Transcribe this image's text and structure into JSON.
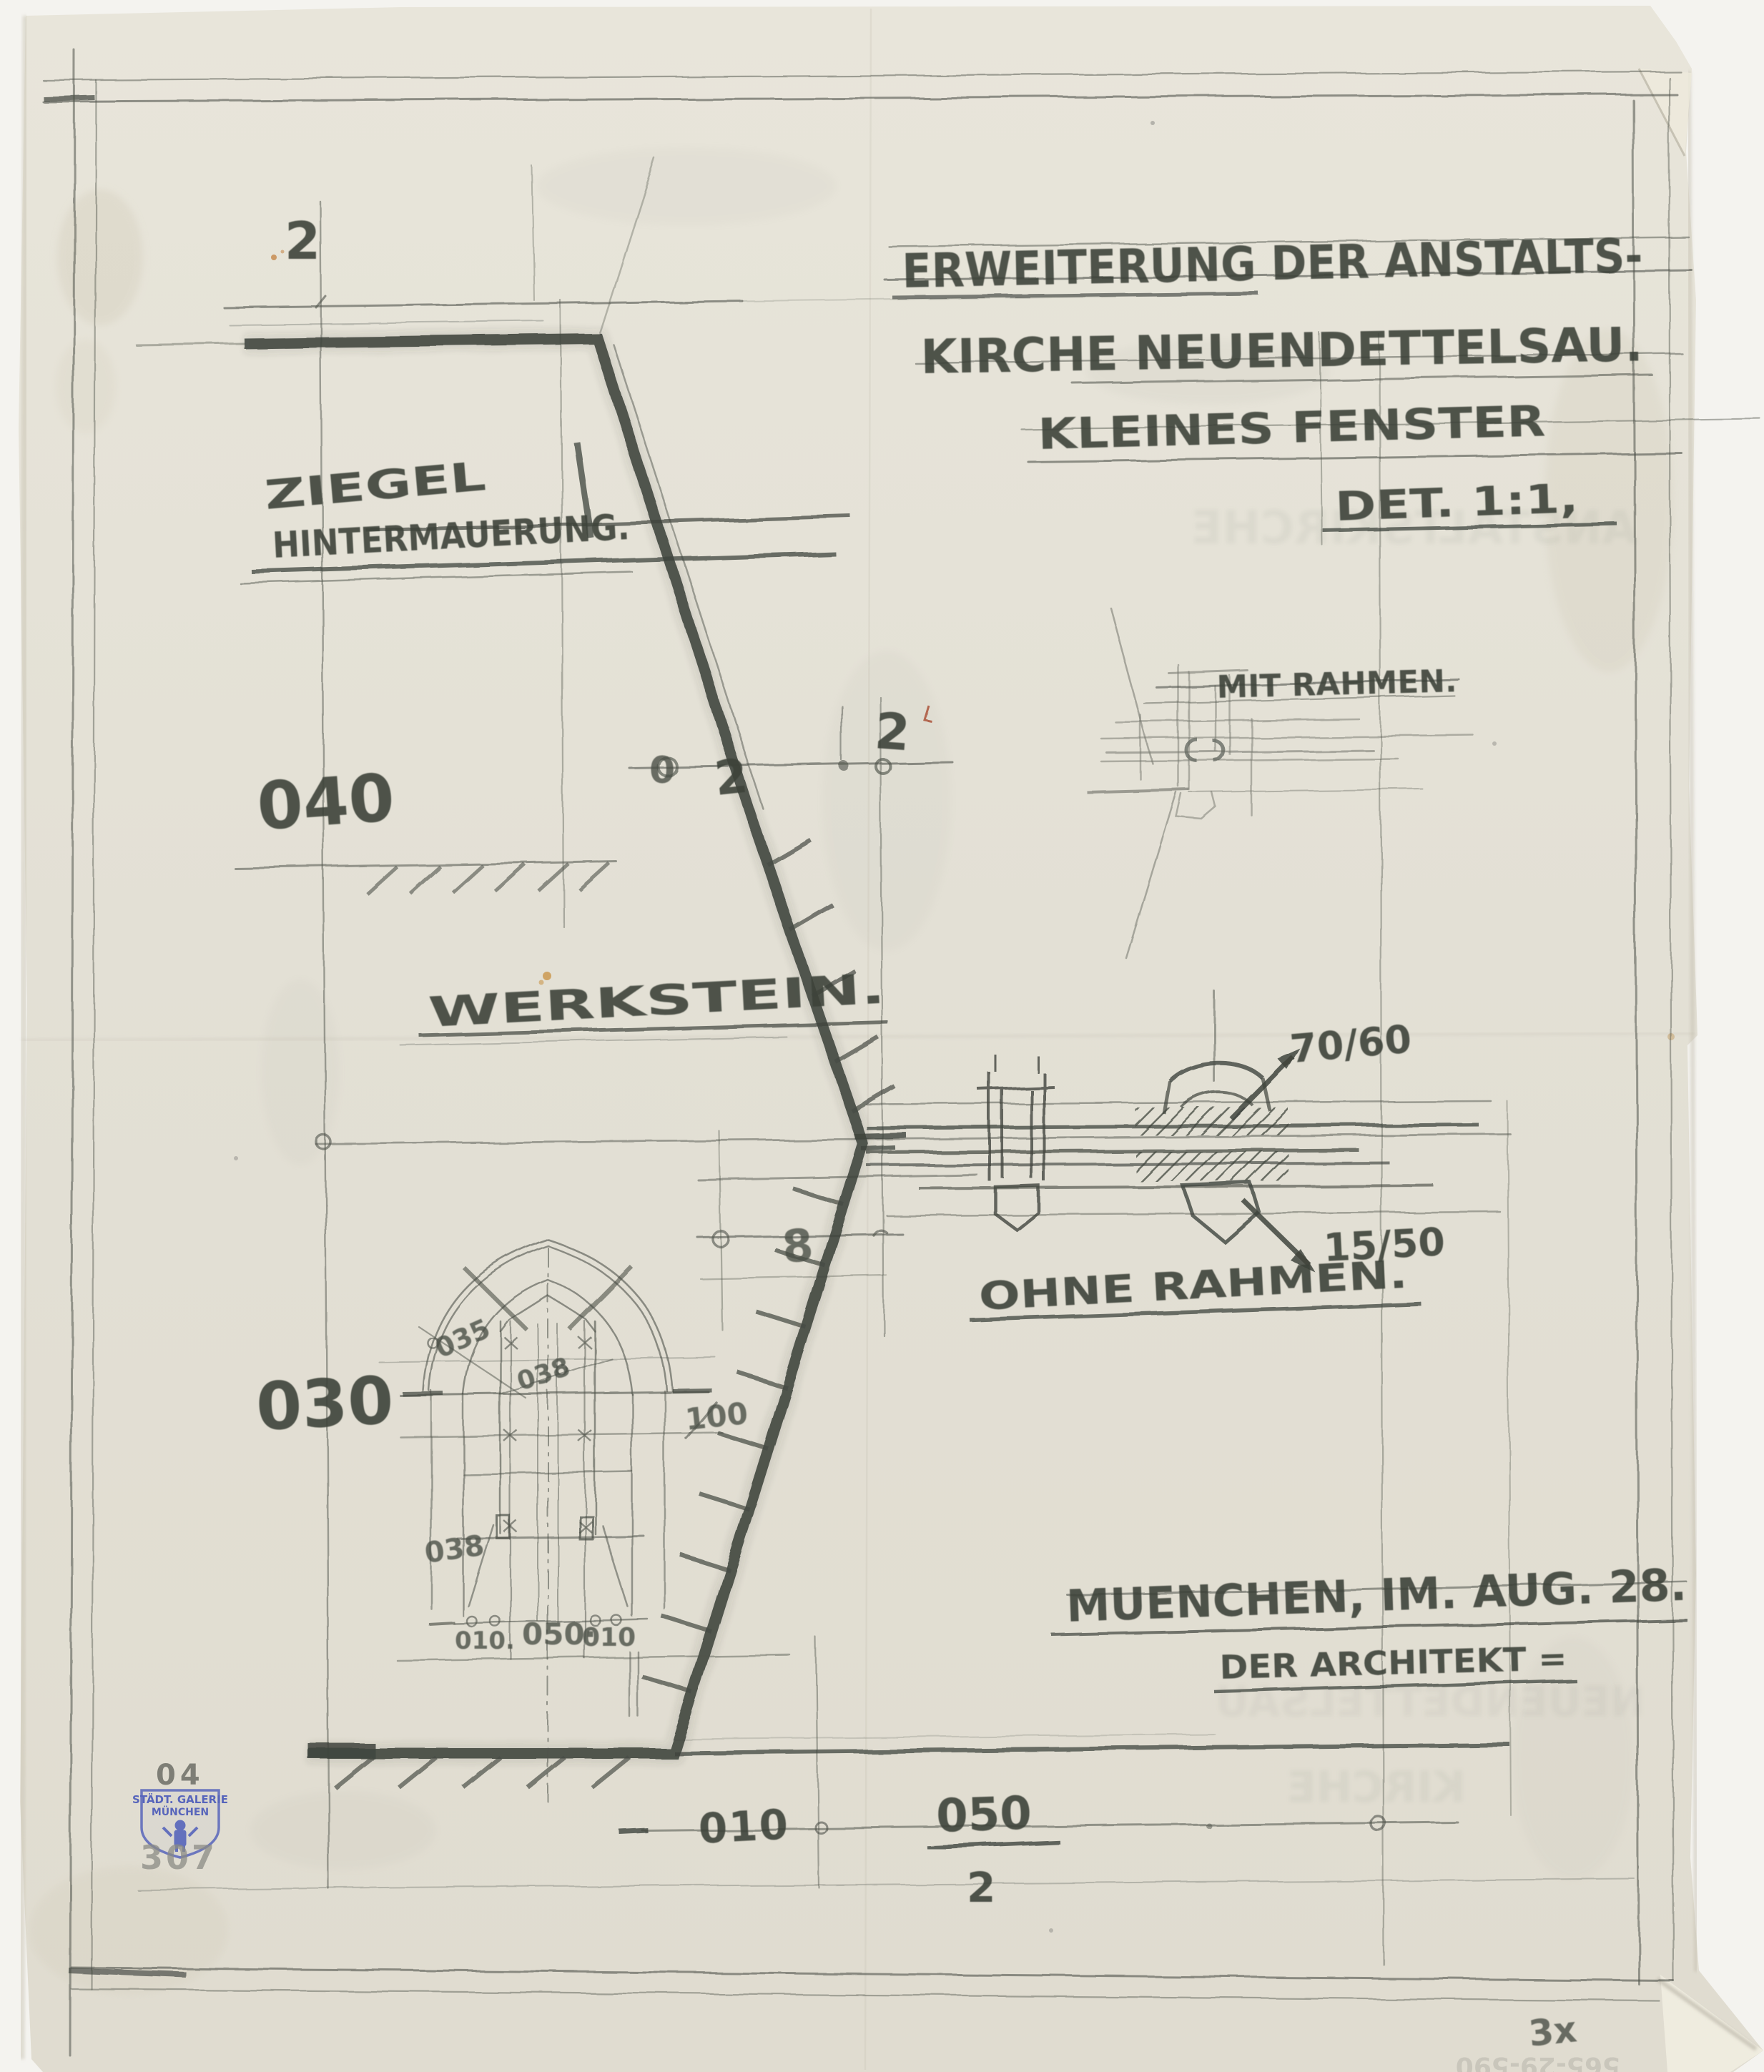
{
  "document": {
    "kind": "hand-drawn architectural pencil sketch",
    "title": {
      "line1": "ERWEITERUNG DER ANSTALTS-",
      "line2": "KIRCHE NEUENDETTELSAU."
    },
    "subtitle": {
      "line1": "KLEINES FENSTER",
      "line2": "DET. 1:1,"
    },
    "labels": {
      "mit_rahmen": "MIT RAHMEN.",
      "ohne_rahmen": "OHNE RAHMEN.",
      "ziegel_line1": "ZIEGEL",
      "ziegel_line2": "HINTERMAUERUNG.",
      "werkstein": "WERKSTEIN.",
      "city_date": "MUENCHEN, IM. AUG. 28.",
      "architect": "DER ARCHITEKT ="
    },
    "dimensions": {
      "top_width": "2",
      "left_upper": "040",
      "left_lower": "030",
      "mid_left_zero": "0",
      "mid_left_two": "2",
      "mid_right_two": "2",
      "sill_eight": "8",
      "beam_upper": "70/60",
      "beam_lower": "15/50",
      "bottom_left": "010",
      "bottom_right_numerator": "050",
      "bottom_right_denominator": "2"
    },
    "window_detail": {
      "arc_radius": "035",
      "mullion_width": "038",
      "lower_width": "038",
      "height": "100",
      "bottom_left": "010.",
      "bottom_center": "050·",
      "bottom_right": "010"
    },
    "stamp": {
      "inventory_top": "04",
      "gallery_line1": "STÄDT. GALERIE",
      "gallery_line2": "MÜNCHEN",
      "inventory_bottom": "307"
    },
    "corner_note": "3x",
    "faint_number": "565-29-590",
    "ghost_text": {
      "upper": "ANSTALTSKIRCHE",
      "lower_1": "NEUENDETTELSAU",
      "lower_2": "KIRCHE"
    },
    "colors": {
      "paper": "#e5e2d7",
      "background": "#f4f3ef",
      "pencil_dark": "#3e433b",
      "pencil_light": "#84877c",
      "stamp_blue": "#5765bb",
      "red_mark": "#a84a30",
      "stain_orange": "#c8903f"
    }
  }
}
